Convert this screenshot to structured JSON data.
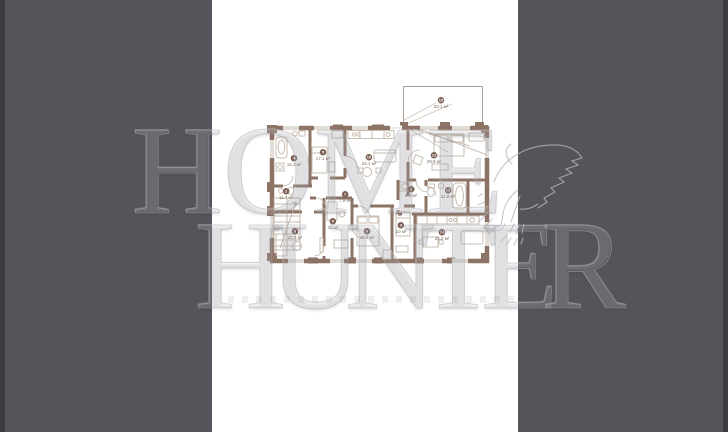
{
  "viewer": {
    "description": "photo viewer with floor plan image letterboxed between dark side panels",
    "panel_color": "#54555b",
    "image_background": "#ffffff"
  },
  "watermark": {
    "line1": "HOME",
    "line2": "HUNTER",
    "logo_icon": "hunting-bird",
    "color": "#aeafb5"
  },
  "plan": {
    "wall_color": "#8d7365",
    "furniture_color": "#c9bcb0",
    "badge_color": "#7b6053",
    "rooms": [
      {
        "number": "4",
        "area": "16.2 м²"
      },
      {
        "number": "2",
        "area": "11.7 м²"
      },
      {
        "number": "5",
        "area": "17.1 м²"
      },
      {
        "number": "10",
        "area": "24.1 м²"
      },
      {
        "number": "12",
        "area": "29.8 м²"
      },
      {
        "number": "7",
        "area": "7.9 м²"
      },
      {
        "number": "1",
        "area": "6.0 м²"
      },
      {
        "number": "13",
        "area": "11.8 м²"
      },
      {
        "number": "8",
        "area": "22.3 м²"
      },
      {
        "number": "6",
        "area": "10 м²"
      },
      {
        "number": "9",
        "area": "16.4 м²"
      },
      {
        "number": "3",
        "area": "10 м²"
      },
      {
        "number": "14",
        "area": "25.2 м²"
      },
      {
        "number": "15",
        "area": "33.1 м²"
      }
    ]
  }
}
